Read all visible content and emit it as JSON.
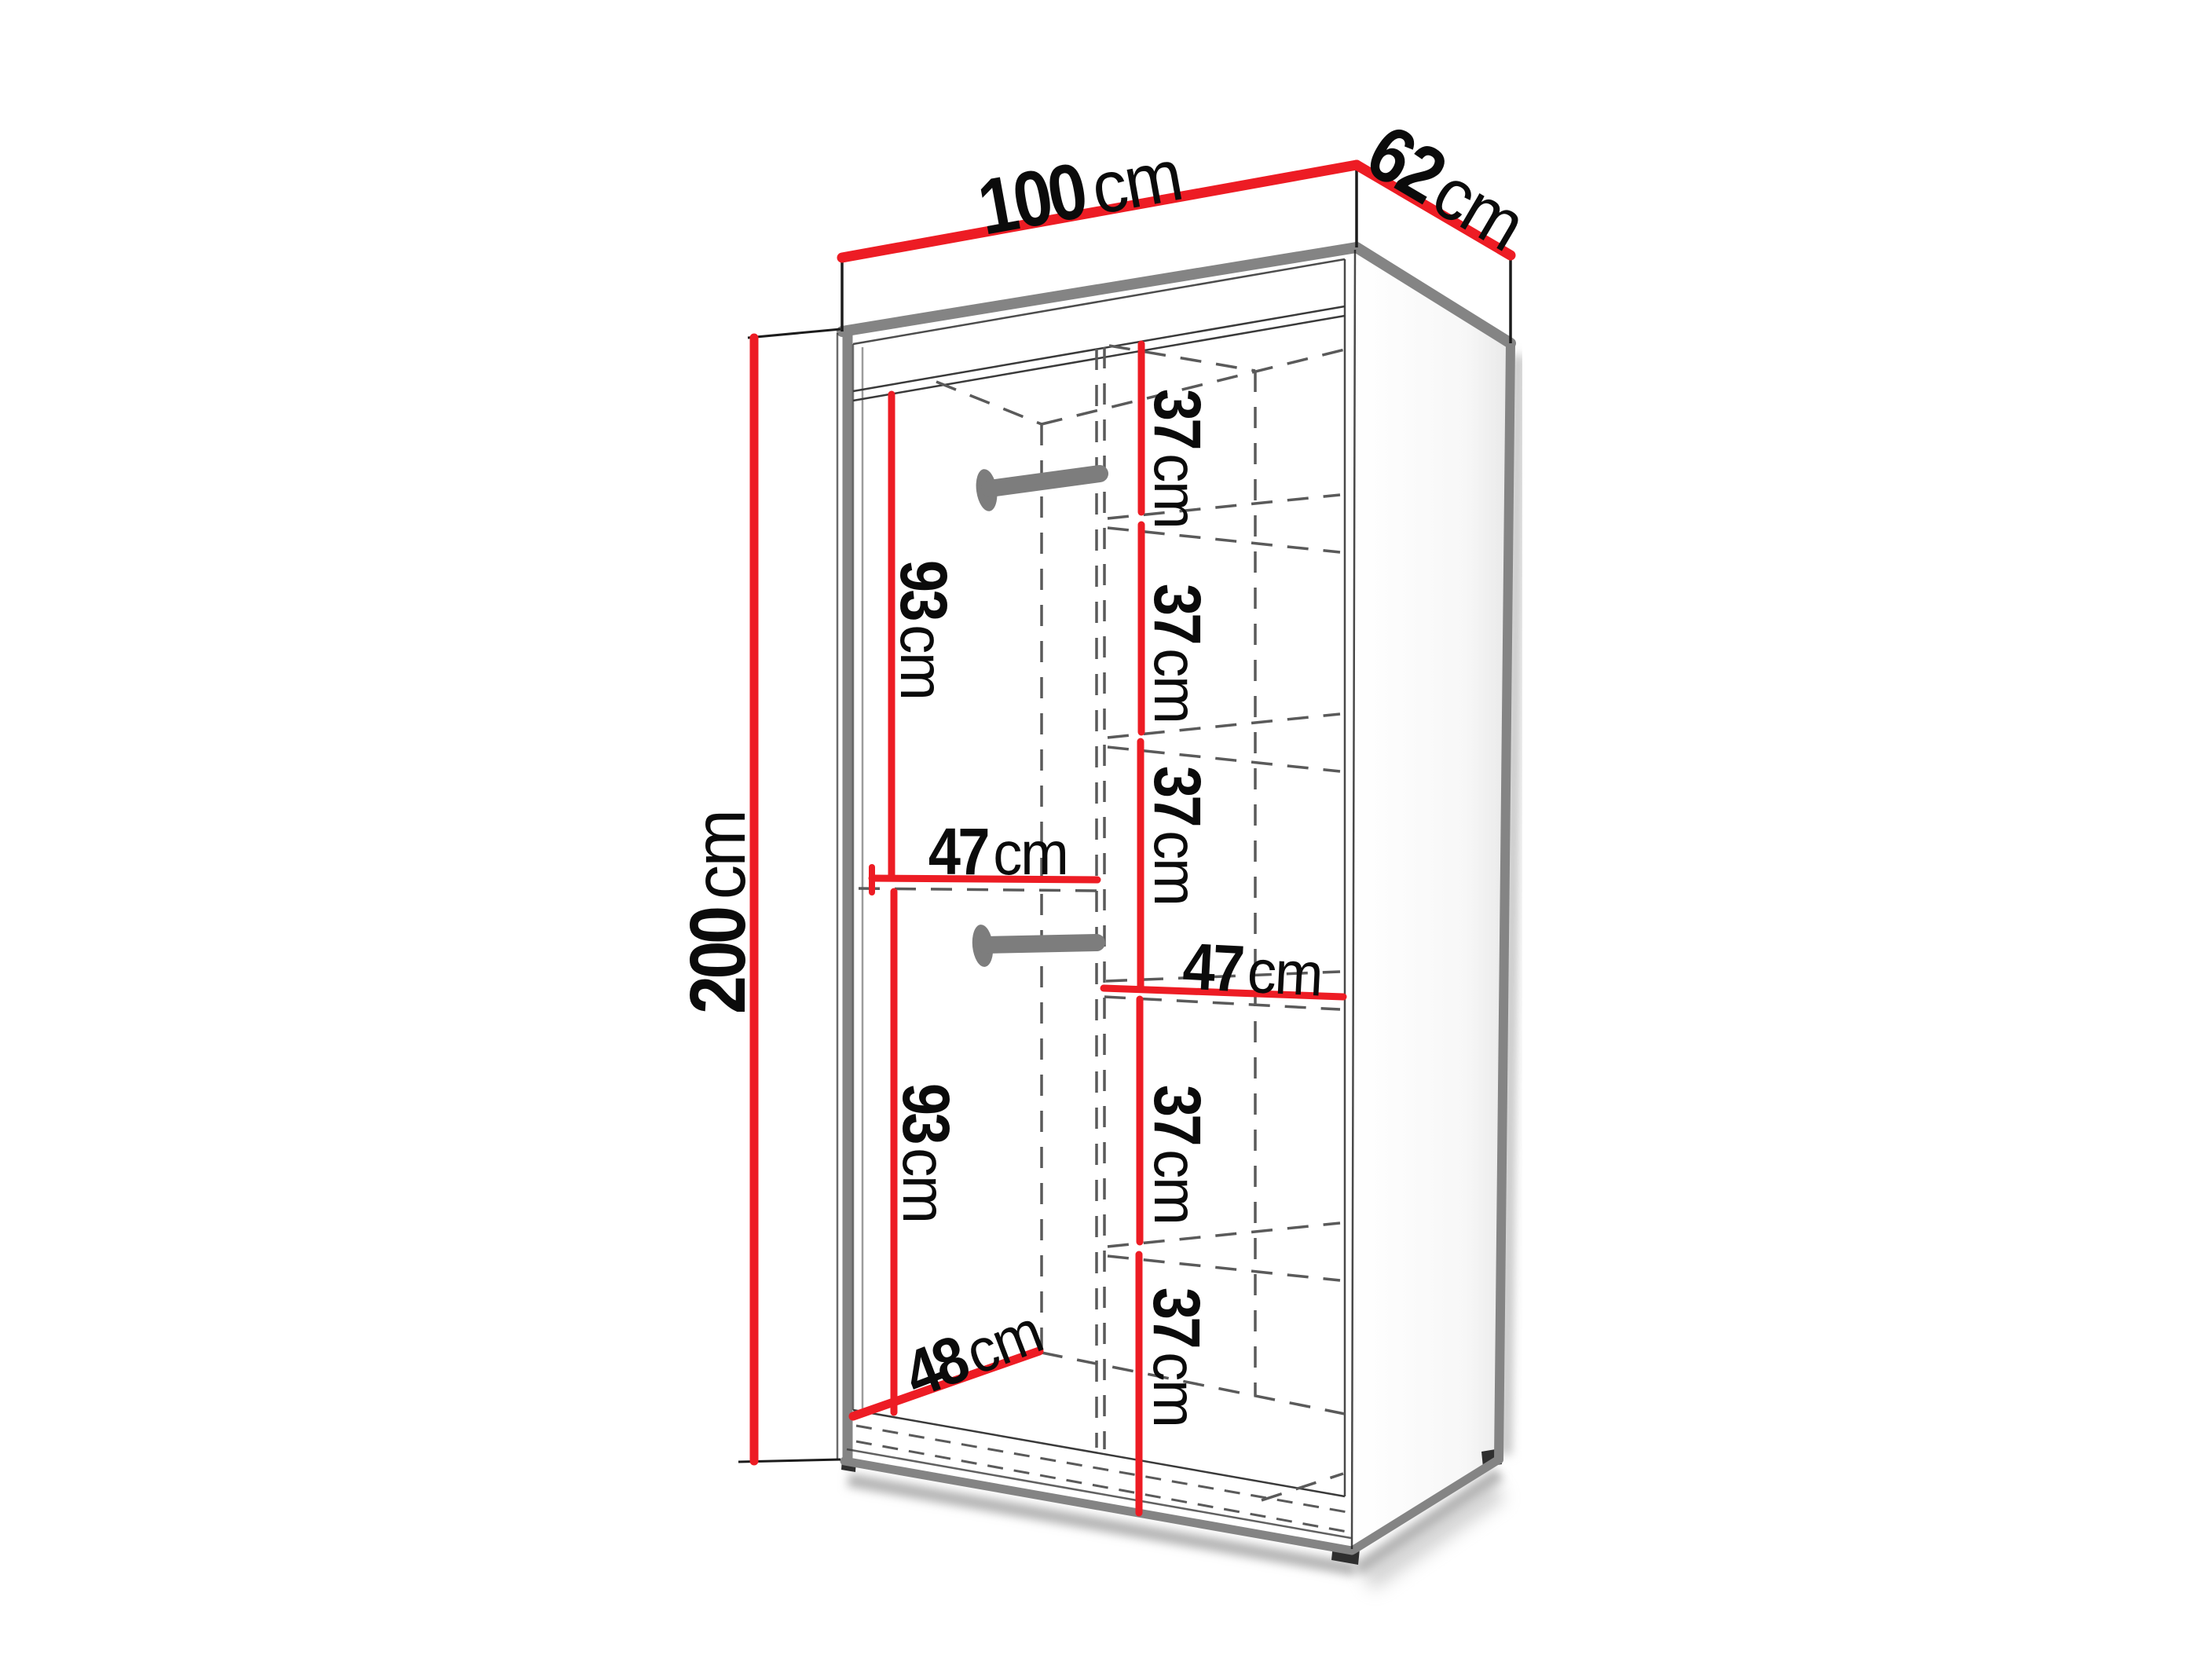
{
  "diagram": {
    "type": "wardrobe-dimension-diagram",
    "unit": "cm",
    "overall": {
      "width_cm": 100,
      "depth_cm": 62,
      "height_cm": 200
    },
    "colors": {
      "dimension_line": "#ed1c24",
      "edge_gray": "#848484",
      "dashed_gray": "#5a5a5a",
      "outline_black": "#1c1c1c",
      "rail_gray": "#7d7d7d",
      "text": "#0b0b0b"
    },
    "labels": {
      "width_top": {
        "value": "100",
        "unit": "cm"
      },
      "depth_top": {
        "value": "62",
        "unit": "cm"
      },
      "height_left": {
        "value": "200",
        "unit": "cm"
      },
      "hanging_upper": {
        "value": "93",
        "unit": "cm"
      },
      "shelf_width_left": {
        "value": "47",
        "unit": "cm"
      },
      "hanging_lower": {
        "value": "93",
        "unit": "cm"
      },
      "floor_depth": {
        "value": "48",
        "unit": "cm"
      },
      "shelf_width_right": {
        "value": "47",
        "unit": "cm"
      },
      "shelf_gap_1": {
        "value": "37",
        "unit": "cm"
      },
      "shelf_gap_2": {
        "value": "37",
        "unit": "cm"
      },
      "shelf_gap_3": {
        "value": "37",
        "unit": "cm"
      },
      "shelf_gap_4": {
        "value": "37",
        "unit": "cm"
      },
      "shelf_gap_5": {
        "value": "37",
        "unit": "cm"
      }
    }
  }
}
